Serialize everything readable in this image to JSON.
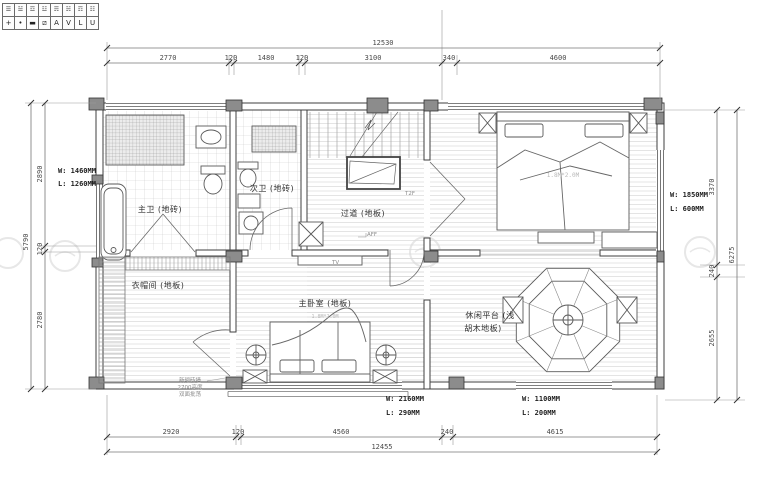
{
  "legend": {
    "row1": [
      "☰",
      "☱",
      "☲",
      "☳",
      "☴",
      "☵",
      "☶",
      "☷"
    ],
    "row2": [
      "+",
      "•",
      "▬",
      "⧄",
      "A",
      "V",
      "L",
      "U"
    ]
  },
  "dimensions": {
    "top": {
      "overall": "12530",
      "segments": [
        "2770",
        "120",
        "1480",
        "120",
        "3100",
        "340",
        "4600"
      ]
    },
    "bottom": {
      "overall": "12455",
      "segments": [
        "2920",
        "120",
        "4560",
        "240",
        "4615"
      ]
    },
    "left": {
      "overall": "5790",
      "segments": [
        "2890",
        "120",
        "2780"
      ]
    },
    "right": {
      "overall": "6275",
      "segments": [
        "3370",
        "240",
        "2655"
      ]
    }
  },
  "windows": {
    "left": {
      "w": "W: 1460MM",
      "l": "L: 1260MM"
    },
    "right": {
      "w": "W: 1850MM",
      "l": "L: 600MM"
    },
    "bottom_center": {
      "w": "W: 2160MM",
      "l": "L: 290MM"
    },
    "bottom_right": {
      "w": "W: 1100MM",
      "l": "L: 200MM"
    }
  },
  "rooms": {
    "master_bath": "主卫 (地砖)",
    "second_bath": "次卫 (地砖)",
    "corridor": "过道 (地板)",
    "closet": "衣帽间 (地板)",
    "master_bedroom": "主卧室 (地板)",
    "leisure_line1": "休闲平台 (浅",
    "leisure_line2": "胡木地板)"
  },
  "furniture": {
    "bed_size": "1.8M*2.0M",
    "tv": "TV"
  },
  "notes": {
    "closet_note1": "新砌砖墙",
    "closet_note2": "2700高度",
    "closet_note3": "双面批荡",
    "level_mark1": "T2F",
    "level_mark2": "AFF"
  },
  "colors": {
    "wall": "#3f3f3f",
    "column_fill": "#8c8c8c",
    "wood_hatch": "#d8d8d8",
    "tile_hatch": "#cccccc",
    "dim_text": "#4a4a4a",
    "annotation_text": "#1e1e1e",
    "watermark": "#e7e7e7"
  }
}
